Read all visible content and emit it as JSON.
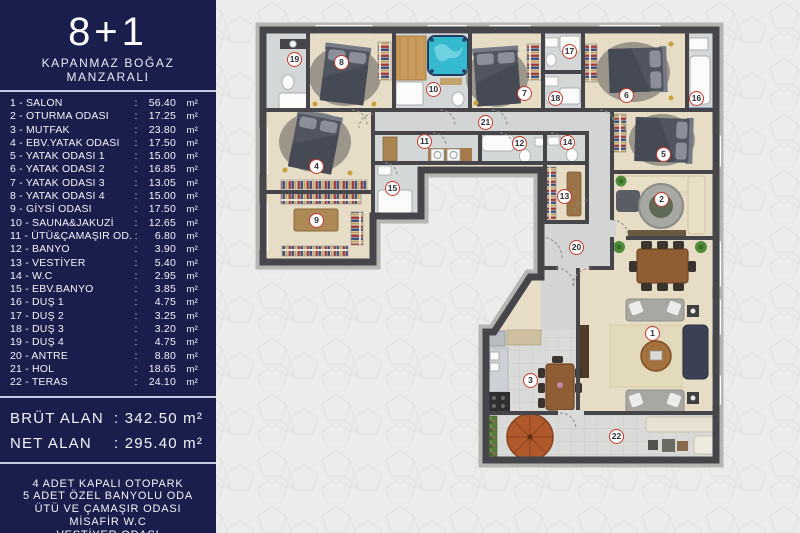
{
  "sidebar": {
    "title": "8+1",
    "subtitle": "KAPANMAZ BOĞAZ MANZARALI",
    "colon": ":",
    "unit": "m²",
    "totals": [
      {
        "label": "BRÜT ALAN",
        "value": ": 342.50 m²"
      },
      {
        "label": "NET ALAN",
        "value": ": 295.40 m²"
      }
    ]
  },
  "rooms": [
    {
      "num": "1",
      "label": "1 - SALON",
      "area": "56.40",
      "x": 653,
      "y": 334
    },
    {
      "num": "2",
      "label": "2 - OTURMA ODASI",
      "area": "17.25",
      "x": 662,
      "y": 200
    },
    {
      "num": "3",
      "label": "3 - MUTFAK",
      "area": "23.80",
      "x": 531,
      "y": 381
    },
    {
      "num": "4",
      "label": "4 - EBV.YATAK ODASI",
      "area": "17.50",
      "x": 317,
      "y": 167
    },
    {
      "num": "5",
      "label": "5 - YATAK ODASI 1",
      "area": "15.00",
      "x": 664,
      "y": 155
    },
    {
      "num": "6",
      "label": "6 - YATAK ODASI 2",
      "area": "16.85",
      "x": 627,
      "y": 96
    },
    {
      "num": "7",
      "label": "7 - YATAK ODASI 3",
      "area": "13.05",
      "x": 525,
      "y": 94
    },
    {
      "num": "8",
      "label": "8 - YATAK ODASI 4",
      "area": "15.00",
      "x": 342,
      "y": 63
    },
    {
      "num": "9",
      "label": "9 - GİYSİ ODASI",
      "area": "17.50",
      "x": 317,
      "y": 221
    },
    {
      "num": "10",
      "label": "10 - SAUNA&JAKUZİ",
      "area": "12.65",
      "x": 434,
      "y": 90
    },
    {
      "num": "11",
      "label": "11 - ÜTÜ&ÇAMAŞIR OD.",
      "area": "6.80",
      "x": 425,
      "y": 142
    },
    {
      "num": "12",
      "label": "12 - BANYO",
      "area": "3.90",
      "x": 520,
      "y": 144
    },
    {
      "num": "13",
      "label": "13 - VESTİYER",
      "area": "5.40",
      "x": 565,
      "y": 197
    },
    {
      "num": "14",
      "label": "14 - W.C",
      "area": "2.95",
      "x": 568,
      "y": 143
    },
    {
      "num": "15",
      "label": "15 - EBV.BANYO",
      "area": "3.85",
      "x": 393,
      "y": 189
    },
    {
      "num": "16",
      "label": "16 - DUŞ 1",
      "area": "4.75",
      "x": 697,
      "y": 99
    },
    {
      "num": "17",
      "label": "17 - DUŞ 2",
      "area": "3.25",
      "x": 570,
      "y": 52
    },
    {
      "num": "18",
      "label": "18 - DUŞ 3",
      "area": "3.20",
      "x": 556,
      "y": 99
    },
    {
      "num": "19",
      "label": "19 - DUŞ 4",
      "area": "4.75",
      "x": 295,
      "y": 60
    },
    {
      "num": "20",
      "label": "20 - ANTRE",
      "area": "8.80",
      "x": 577,
      "y": 248
    },
    {
      "num": "21",
      "label": "21 - HOL",
      "area": "18.65",
      "x": 486,
      "y": 123
    },
    {
      "num": "22",
      "label": "22 - TERAS",
      "area": "24.10",
      "x": 617,
      "y": 437
    }
  ],
  "footer_lines": [
    {
      "text": "4 ADET KAPALI OTOPARK"
    },
    {
      "text": "5 ADET ÖZEL BANYOLU ODA"
    },
    {
      "text": "ÜTÜ VE ÇAMAŞIR ODASI"
    },
    {
      "text": "MİSAFİR W.C"
    },
    {
      "text": "VESTİYER ODASI"
    },
    {
      "text": "SAUNA, JAZKUZİ, SPA ALANI"
    }
  ],
  "colors": {
    "sidebar_navy": "#1a1e4c",
    "separator": "#c7cce6",
    "marker_ring_red": "#c0392b",
    "wall_dark": "#46464a",
    "floor_beige": "#e7ddc7",
    "floor_tile_gray": "#d4d7d8",
    "jacuzzi_teal": "#35b9cf",
    "sauna_wood": "#c89a5c",
    "umbrella_terracotta": "#b05a2c"
  }
}
